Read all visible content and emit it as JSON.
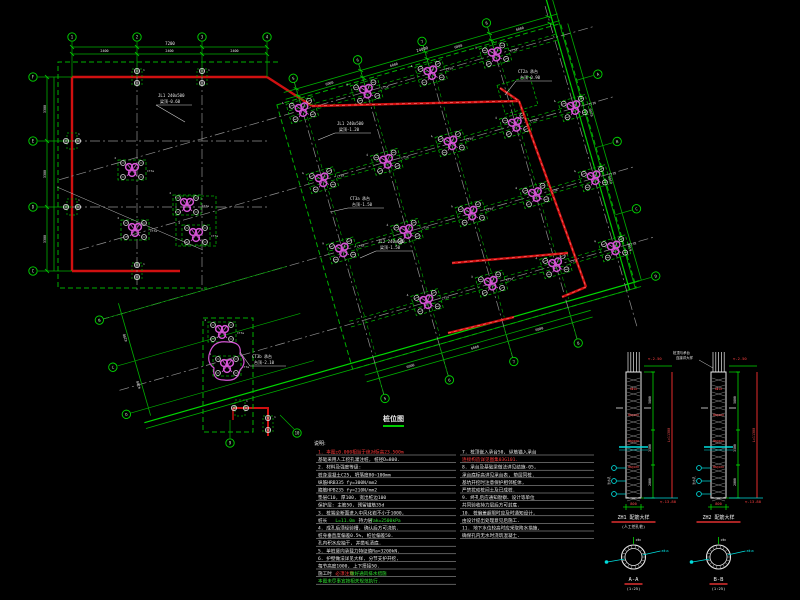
{
  "drawing": {
    "title": {
      "text": "桩位图"
    },
    "colors": {
      "green": "#00b000",
      "green2": "#00d800",
      "red": "#d01010",
      "magenta": "#d455d4",
      "gray": "#8f8f8f",
      "white": "#e8e8e8",
      "cyan": "#00dddd"
    },
    "ortho": {
      "top_total": "7200",
      "top_dims": [
        "2400",
        "2400",
        "2400"
      ],
      "left_dims": [
        "3300",
        "3300",
        "3300"
      ],
      "top_bubbles": [
        "1",
        "2",
        "3",
        "4"
      ],
      "left_bubbles": [
        "F",
        "E",
        "D",
        "C"
      ]
    },
    "rotated": {
      "top_total": "24000",
      "top_dims": [
        "6000",
        "6000",
        "6000",
        "6000"
      ],
      "bottom_dims": [
        "6000",
        "6000",
        "6000"
      ],
      "right_dims": [
        "6300",
        "6300",
        "6300"
      ],
      "wing_dims": [
        "4200",
        "4200"
      ],
      "top_bubbles": [
        "5",
        "6",
        "7",
        "8"
      ],
      "bottom_bubbles": [
        "5",
        "6",
        "7",
        "8"
      ],
      "right_bubbles": [
        "A",
        "B",
        "C",
        "D"
      ],
      "wing_bubbles": [
        "B",
        "C",
        "D"
      ],
      "extra_bubbles": [
        "9",
        "10"
      ]
    },
    "leaders": [
      {
        "l1": "JL1 240x500",
        "l2": "梁顶-0.60"
      },
      {
        "l1": "JL1 240x500",
        "l2": "梁顶-1.20"
      },
      {
        "l1": "CT3a 承台",
        "l2": "台顶-1.50"
      },
      {
        "l1": "JL2 240x600",
        "l2": "梁顶-1.50"
      },
      {
        "l1": "CT3b 承台",
        "l2": "台顶-2.10"
      },
      {
        "l1": "CT2a 承台",
        "l2": "台顶-0.90"
      }
    ],
    "cap_tag": "CT3a"
  },
  "notes": {
    "header": "说明:",
    "left": [
      {
        "segs": [
          [
            "1. 本图±0.000相当于绝对标高23.500m",
            "red"
          ]
        ]
      },
      {
        "segs": [
          [
            "   基础采用人工挖孔灌注桩, 桩径D=800.",
            "white"
          ]
        ]
      },
      {
        "segs": [
          [
            "2. 材料及强度等级:",
            "white"
          ]
        ]
      },
      {
        "segs": [
          [
            "   桩身混凝土C25, 坍落度80~100mm",
            "white"
          ]
        ]
      },
      {
        "segs": [
          [
            "   纵筋HRB335  fy=300N/mm2",
            "white"
          ]
        ]
      },
      {
        "segs": [
          [
            "   箍筋HPB235  fy=210N/mm2",
            "white"
          ]
        ]
      },
      {
        "segs": [
          [
            "   垫层C10, 厚100, 宽出桩边100",
            "white"
          ]
        ]
      },
      {
        "segs": [
          [
            "   保护层: 主筋50, 预留锚筋35d",
            "white"
          ]
        ]
      },
      {
        "segs": [
          [
            "3. 桩端全断面进入中风化岩不小于1000,",
            "white"
          ]
        ]
      },
      {
        "segs": [
          [
            "   桩长 ",
            "white"
          ],
          [
            "L=11.0m ",
            "green"
          ],
          [
            "持力层 ",
            "white"
          ],
          [
            "fak=2500kPa",
            "green"
          ]
        ]
      },
      {
        "segs": [
          [
            "4. 成孔后须经验槽, 确认后方可浇筑.",
            "white"
          ]
        ]
      },
      {
        "segs": [
          [
            "   桩身垂直度偏差0.5%, 桩位偏差50.",
            "white"
          ]
        ]
      },
      {
        "segs": [
          [
            "   孔内积水应抽干, 并凿毛清底.",
            "white"
          ]
        ]
      },
      {
        "segs": [
          [
            "5. 单桩竖向承载力特征值Ra=3200kN.",
            "white"
          ]
        ]
      },
      {
        "segs": [
          [
            "6. 护壁做法详见大样, 分节支护开挖,",
            "white"
          ]
        ]
      },
      {
        "segs": [
          [
            "   每节高度1000, 上下搭接50.",
            "white"
          ]
        ]
      },
      {
        "segs": [
          [
            "   施工时",
            "white"
          ],
          [
            "必须注意 ",
            "red"
          ],
          [
            "做好通风排水措施",
            "green"
          ]
        ]
      },
      {
        "segs": [
          [
            "   本图未尽事宜按相关规范执行.",
            "green"
          ]
        ]
      }
    ],
    "right": [
      {
        "segs": [
          [
            "7. 桩顶嵌入承台50, 纵筋锚入承台",
            "white"
          ]
        ]
      },
      {
        "segs": [
          [
            "   连接构造详见图集03G101.",
            "red"
          ]
        ]
      },
      {
        "segs": [
          [
            "8. 承台及基础梁做法详见结施-05,",
            "white"
          ]
        ]
      },
      {
        "segs": [
          [
            "   承台底标高详见承台表, 垫层同桩.",
            "white"
          ]
        ]
      },
      {
        "segs": [
          [
            "   基坑开挖时注意保护相邻桩体,",
            "white"
          ]
        ]
      },
      {
        "segs": [
          [
            "   严禁扰动桩间土及已成桩.",
            "white"
          ]
        ]
      },
      {
        "segs": [
          [
            "9. 终孔后应通知勘察、设计等单位",
            "white"
          ]
        ]
      },
      {
        "segs": [
          [
            "   共同验收持力层后方可封底.",
            "white"
          ]
        ]
      },
      {
        "segs": [
          [
            "10. 桩偏差超限时应及时通知设计,",
            "white"
          ]
        ]
      },
      {
        "segs": [
          [
            "    由设计提出处理意见后施工.",
            "white"
          ]
        ]
      },
      {
        "segs": [
          [
            "11. 地下水位较高时应采取降水措施,",
            "white"
          ]
        ]
      },
      {
        "segs": [
          [
            "    确保孔内无水时浇筑混凝土.",
            "white"
          ]
        ]
      }
    ]
  },
  "details": [
    {
      "top_elev": "-2.50",
      "side_dims": [
        "5800",
        "3500",
        "2000"
      ],
      "overall": "L=11300",
      "width": "800",
      "bottom_elev": "-13.80",
      "bars": [
        "8Φ16",
        "Φ8@100",
        "Φ8@200",
        "Φ8@100"
      ],
      "label1": "ZH1 配筋大样",
      "label2": "(人工挖孔桩)",
      "ring_note": "2Φ8",
      "cy_left": "泄水孔",
      "cy_right": "8Φ16",
      "sec": "A-A",
      "sec_scale": "(1:25)",
      "leader1": "",
      "leader2": ""
    },
    {
      "top_elev": "-2.50",
      "side_dims": [
        "5800",
        "3500",
        "2000"
      ],
      "overall": "L=11300",
      "width": "800",
      "bottom_elev": "-13.80",
      "bars": [
        "8Φ18",
        "Φ8@100",
        "Φ8@200",
        "Φ8@100"
      ],
      "label1": "ZH2 配筋大样",
      "label2": "",
      "ring_note": "2Φ8",
      "cy_left": "泄水孔",
      "cy_right": "8Φ18",
      "sec": "B-B",
      "sec_scale": "(1:25)",
      "leader1": "桩顶与承台",
      "leader2": "连接详大样"
    }
  ]
}
